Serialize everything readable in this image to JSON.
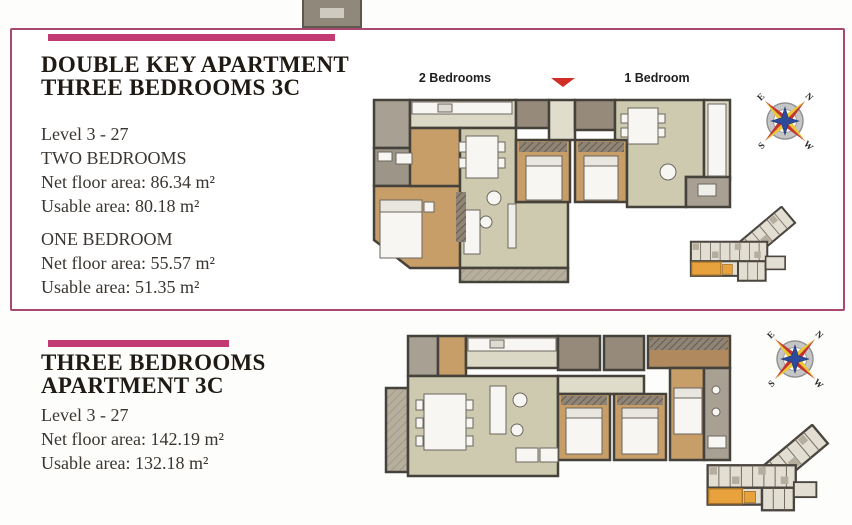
{
  "double_key": {
    "title_line1": "DOUBLE KEY APARTMENT",
    "title_line2": "THREE BEDROOMS 3C",
    "level": "Level 3 - 27",
    "groups": [
      {
        "name": "TWO BEDROOMS",
        "net": "Net floor area: 86.34 m²",
        "usable": "Usable area: 80.18 m²"
      },
      {
        "name": "ONE BEDROOM",
        "net": "Net floor area: 55.57 m²",
        "usable": "Usable area: 51.35 m²"
      }
    ],
    "plan": {
      "label_left": "2 Bedrooms",
      "label_right": "1 Bedroom"
    }
  },
  "three_bedrooms": {
    "title_line1": "THREE BEDROOMS",
    "title_line2": "APARTMENT 3C",
    "level": "Level 3 - 27",
    "net": "Net floor area: 142.19 m²",
    "usable": "Usable area: 132.18 m²"
  },
  "compass": {
    "north": "N",
    "east": "E",
    "south": "S",
    "west": "W"
  },
  "colors": {
    "accent_pink": "#c23a72",
    "box_border": "#a8486f",
    "wall": "#45413b",
    "bedroom_floor": "#c79e68",
    "living_floor": "#cdcab0",
    "bathroom_floor": "#968b7b",
    "balcony_floor": "#b6af9d",
    "entry_floor": "#a8a093",
    "kitchen_floor": "#dbd8c5",
    "highlight_unit_orange": "#e8a23d",
    "entrance_marker_red": "#cf2e27",
    "compass_yellow": "#ecc832",
    "compass_red": "#c4352e",
    "compass_blue": "#2d4a9b"
  }
}
